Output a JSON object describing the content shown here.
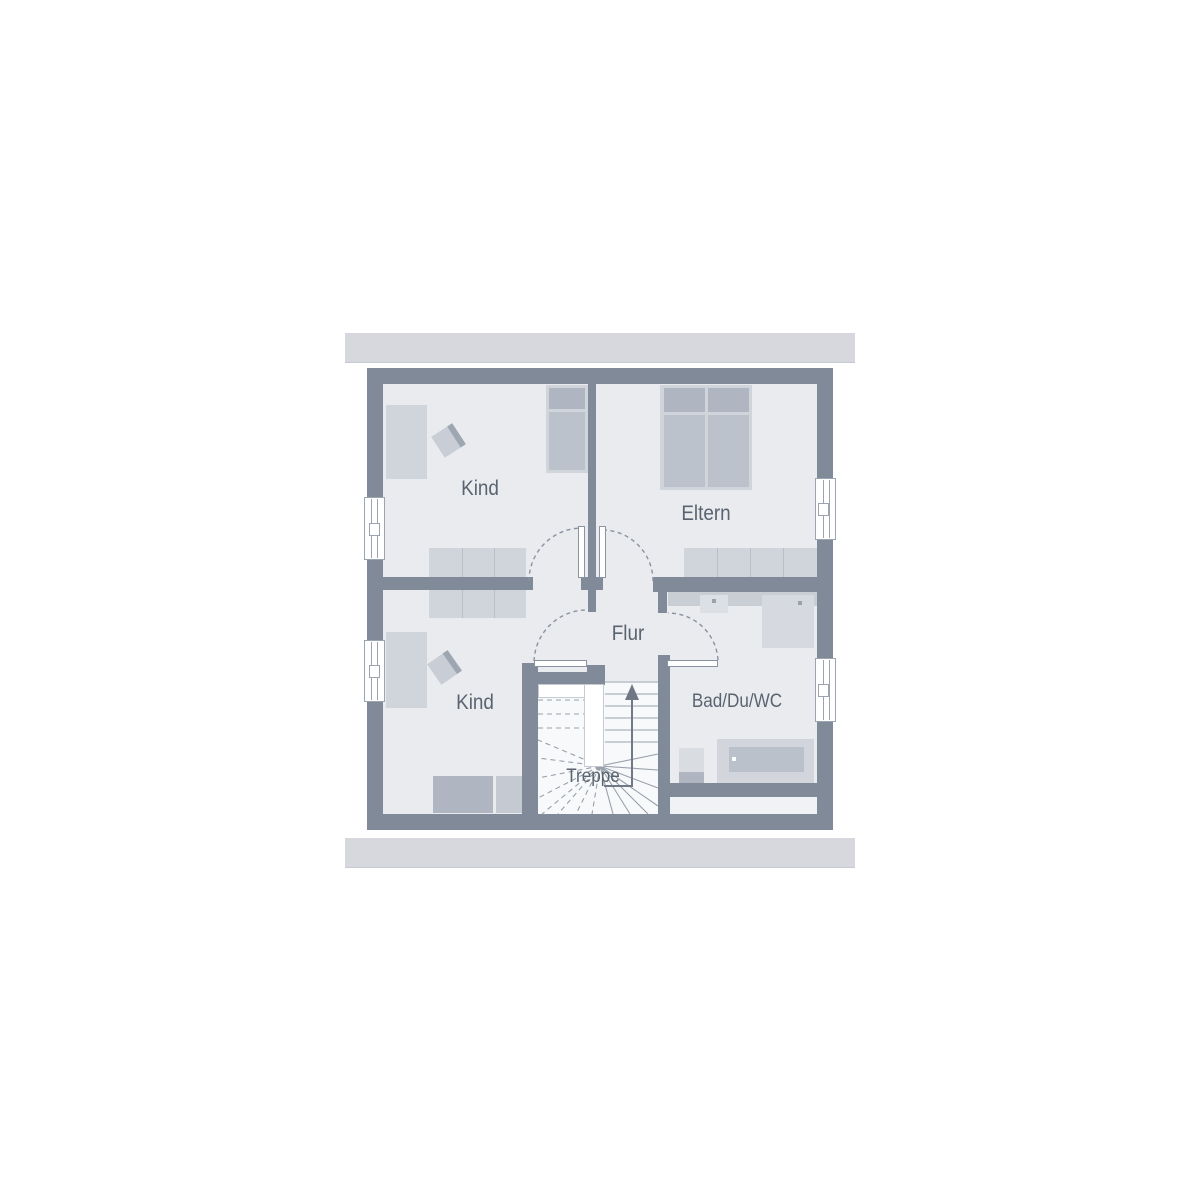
{
  "rooms": {
    "kind_top": {
      "label": "Kind"
    },
    "eltern": {
      "label": "Eltern"
    },
    "flur": {
      "label": "Flur"
    },
    "kind_bottom": {
      "label": "Kind"
    },
    "bad": {
      "label": "Bad/Du/WC"
    },
    "treppe": {
      "label": "Treppe"
    }
  },
  "palette": {
    "background": "#FFFFFF",
    "wall": "#818A98",
    "floor": "#E9EBEF",
    "floor_light": "#F0F2F5",
    "stair_floor": "#F8F9FB",
    "roof_band": "#D6D8DD",
    "furn_light": "#D0D5DC",
    "furn_mid": "#BCC2CB",
    "furn_dark": "#AFB6C1",
    "fixture": "#D9DCE1",
    "counter": "#C9CDD4",
    "label_text": "#5A6470",
    "line_color": "#97A0AB",
    "arc_color": "#8A92A0",
    "arrow_color": "#6F7884",
    "door_line": "#8A93A0",
    "window_frame": "#9CA4AF"
  }
}
